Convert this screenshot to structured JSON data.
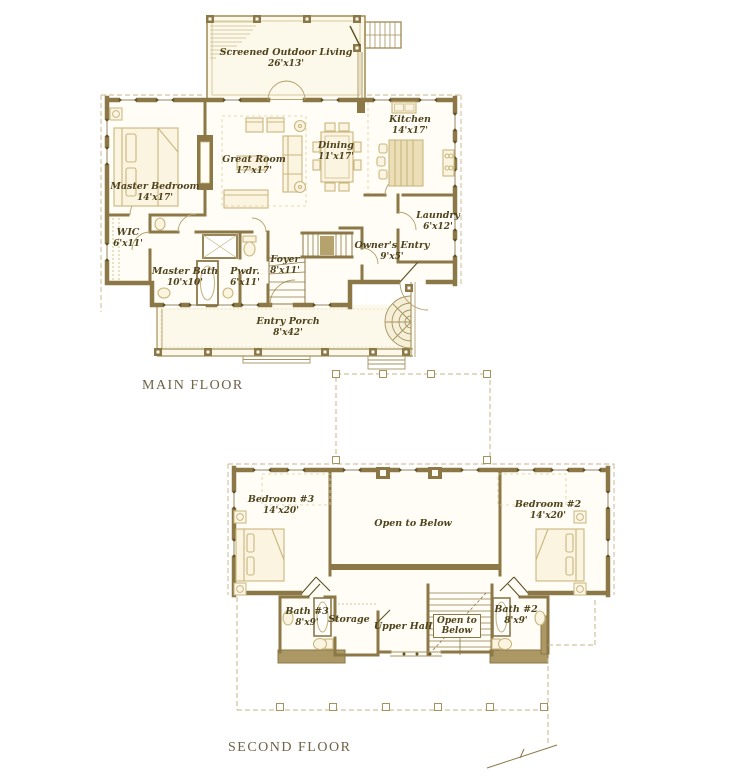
{
  "document": {
    "type": "architectural floor plan",
    "floors": [
      "MAIN FLOOR",
      "SECOND FLOOR"
    ]
  },
  "colors": {
    "wall": "#8c7847",
    "wall_dark": "#5f5226",
    "furniture_line": "#c9b77e",
    "room_fill": "#fffdf6",
    "porch_fill": "#fcf8ea",
    "bay_band": "#ab9865",
    "label_text": "#4f431c",
    "title_text": "#6e6247"
  },
  "main_floor": {
    "title": "MAIN FLOOR",
    "rooms": {
      "screened_outdoor_living": {
        "name": "Screened Outdoor Living",
        "dims": "26'x13'"
      },
      "great_room": {
        "name": "Great Room",
        "dims": "17'x17'"
      },
      "dining": {
        "name": "Dining",
        "dims": "11'x17'"
      },
      "kitchen": {
        "name": "Kitchen",
        "dims": "14'x17'"
      },
      "master_bedroom": {
        "name": "Master Bedroom",
        "dims": "14'x17'"
      },
      "wic": {
        "name": "WIC",
        "dims": "6'x11'"
      },
      "master_bath": {
        "name": "Master Bath",
        "dims": "10'x10'"
      },
      "pwdr": {
        "name": "Pwdr.",
        "dims": "6'x11'"
      },
      "foyer": {
        "name": "Foyer",
        "dims": "8'x11'"
      },
      "owners_entry": {
        "name": "Owner's Entry",
        "dims": "9'x5'"
      },
      "laundry": {
        "name": "Laundry",
        "dims": "6'x12'"
      },
      "entry_porch": {
        "name": "Entry Porch",
        "dims": "8'x42'"
      }
    }
  },
  "second_floor": {
    "title": "SECOND FLOOR",
    "rooms": {
      "bedroom_3": {
        "name": "Bedroom #3",
        "dims": "14'x20'"
      },
      "bedroom_2": {
        "name": "Bedroom #2",
        "dims": "14'x20'"
      },
      "open_to_below": {
        "name": "Open to Below"
      },
      "bath_3": {
        "name": "Bath #3",
        "dims": "8'x9'"
      },
      "storage": {
        "name": "Storage"
      },
      "upper_hall": {
        "name": "Upper Hall"
      },
      "open_to_below_stair": {
        "line1": "Open to",
        "line2": "Below"
      },
      "bath_2": {
        "name": "Bath #2",
        "dims": "8'x9'"
      }
    }
  }
}
